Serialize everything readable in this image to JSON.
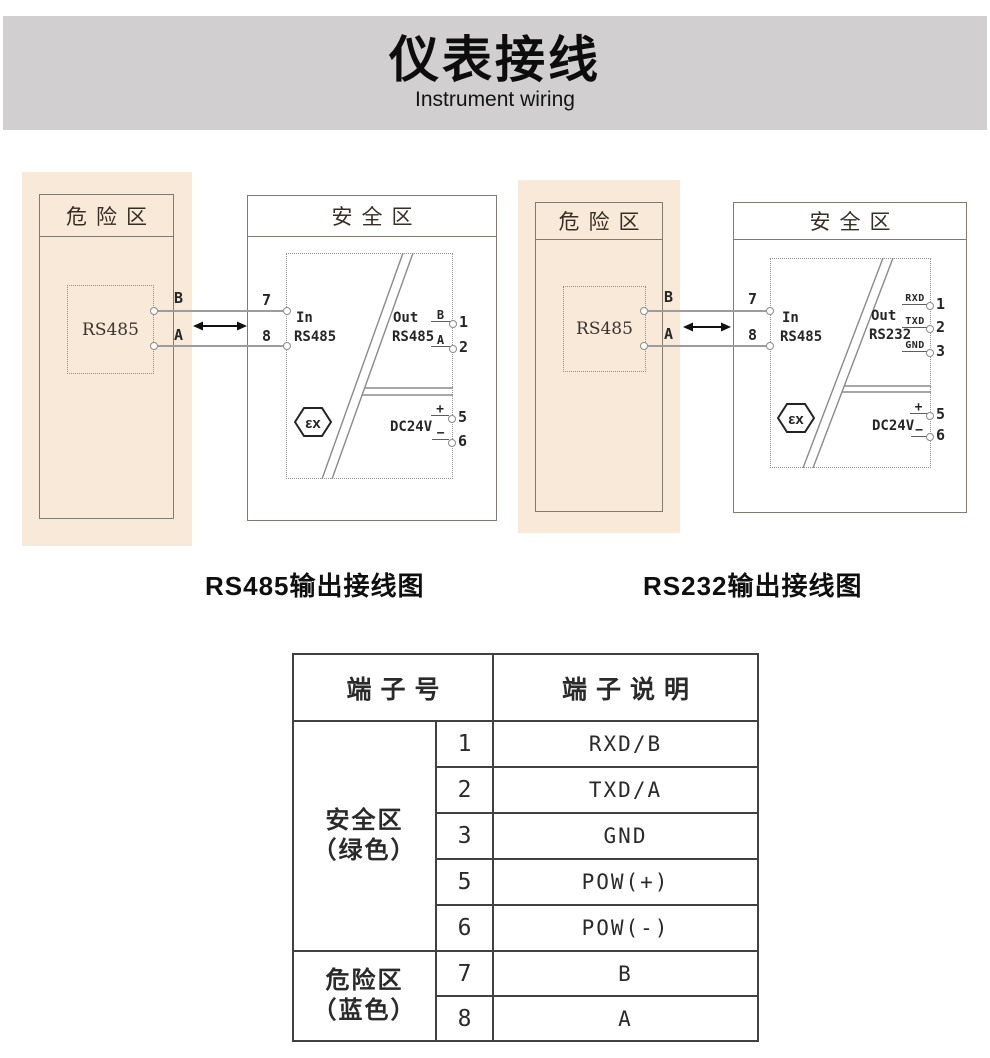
{
  "page": {
    "title": "仪表接线",
    "subtitle": "Instrument wiring"
  },
  "captions": {
    "left": "RS485输出接线图",
    "right": "RS232输出接线图"
  },
  "diagrams": [
    {
      "hazard_zone_label": "危险区",
      "safe_zone_label": "安全区",
      "device_label": "RS485",
      "wire_top_label": "B",
      "wire_bottom_label": "A",
      "in_terminal_top": "7",
      "in_terminal_bottom": "8",
      "in_label": "In",
      "in_type": "RS485",
      "out_label": "Out",
      "out_type": "RS485",
      "ex_mark": "εx",
      "power_label": "DC24V",
      "out_terms": [
        {
          "tag": "B",
          "num": "1"
        },
        {
          "tag": "A",
          "num": "2"
        }
      ],
      "pow_terms": [
        {
          "tag": "+",
          "num": "5"
        },
        {
          "tag": "−",
          "num": "6"
        }
      ]
    },
    {
      "hazard_zone_label": "危险区",
      "safe_zone_label": "安全区",
      "device_label": "RS485",
      "wire_top_label": "B",
      "wire_bottom_label": "A",
      "in_terminal_top": "7",
      "in_terminal_bottom": "8",
      "in_label": "In",
      "in_type": "RS485",
      "out_label": "Out",
      "out_type": "RS232",
      "ex_mark": "εx",
      "power_label": "DC24V",
      "out_terms": [
        {
          "tag": "RXD",
          "num": "1"
        },
        {
          "tag": "TXD",
          "num": "2"
        },
        {
          "tag": "GND",
          "num": "3"
        }
      ],
      "pow_terms": [
        {
          "tag": "+",
          "num": "5"
        },
        {
          "tag": "−",
          "num": "6"
        }
      ]
    }
  ],
  "table": {
    "header_terminal": "端子号",
    "header_description": "端子说明",
    "groups": [
      {
        "zone": "安全区",
        "color_note": "（绿色）",
        "rows": [
          {
            "num": "1",
            "desc": "RXD/B"
          },
          {
            "num": "2",
            "desc": "TXD/A"
          },
          {
            "num": "3",
            "desc": "GND"
          },
          {
            "num": "5",
            "desc": "POW(+)"
          },
          {
            "num": "6",
            "desc": "POW(-)"
          }
        ]
      },
      {
        "zone": "危险区",
        "color_note": "（蓝色）",
        "rows": [
          {
            "num": "7",
            "desc": "B"
          },
          {
            "num": "8",
            "desc": "A"
          }
        ]
      }
    ]
  },
  "colors": {
    "banner_gray": "#d2cfd0",
    "hazard_beige": "#f8e9d9",
    "diagram_line": "#8a8a8a",
    "table_border": "#414141"
  }
}
